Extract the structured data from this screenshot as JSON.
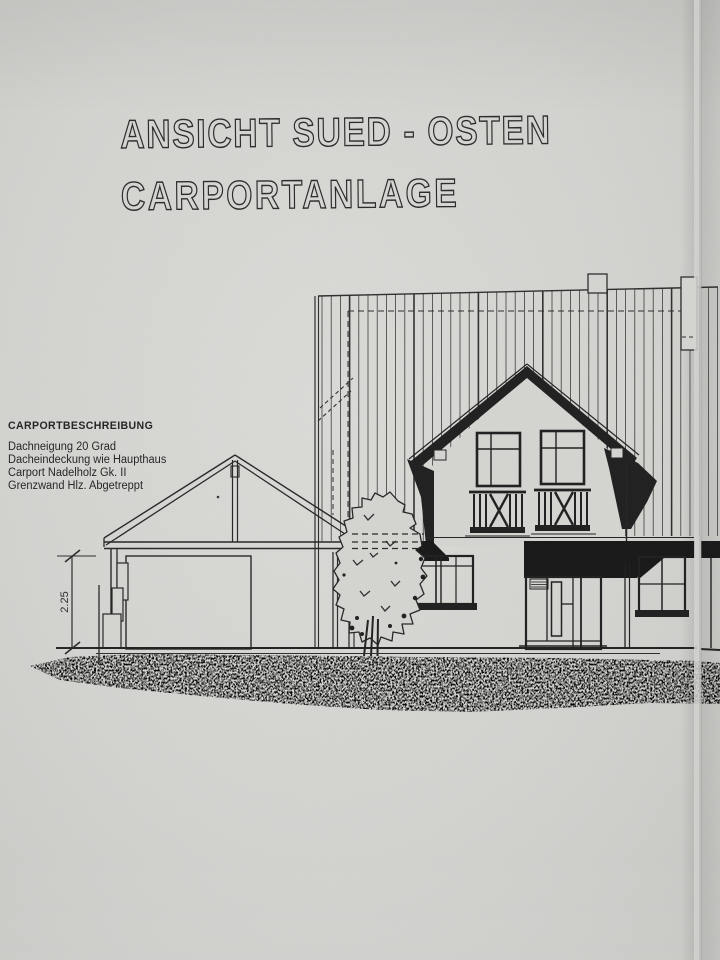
{
  "sheet": {
    "title_line1": "ANSICHT SUED - OSTEN",
    "title_line2": "CARPORTANLAGE",
    "description": {
      "heading": "CARPORTBESCHREIBUNG",
      "lines": [
        "Dachneigung 20 Grad",
        "Dacheindeckung wie Haupthaus",
        "Carport Nadelholz Gk. II",
        "Grenzwand Hlz. Abgetreppt"
      ]
    },
    "dimension_label": "2.25",
    "colors": {
      "paper": "#d4d4d1",
      "ink": "#222222"
    }
  }
}
